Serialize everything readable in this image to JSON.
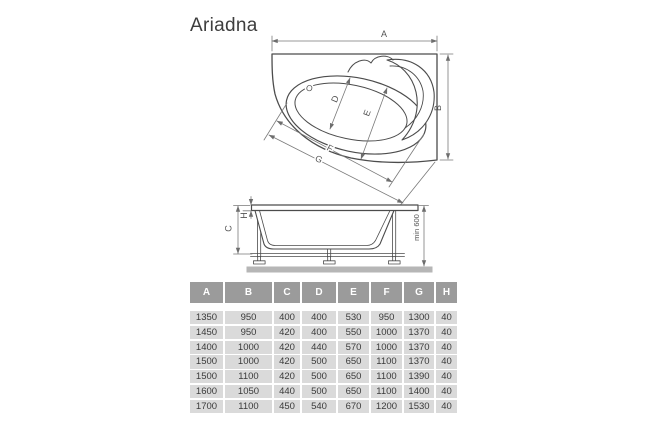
{
  "title": "Ariadna",
  "colors": {
    "outline": "#4c4c4c",
    "dim_line": "#7a7a7a",
    "header_bg": "#9b9b9b",
    "header_text": "#ffffff",
    "row_bg": "#dadada",
    "cell_text": "#3a3a3a",
    "floor": "#b6b6b6"
  },
  "top_view": {
    "labels": {
      "a": "A",
      "b": "B",
      "o": "O",
      "d": "D",
      "e": "E",
      "f": "F",
      "g": "G"
    }
  },
  "side_view": {
    "labels": {
      "c": "C",
      "h": "H",
      "min_height": "min 600"
    }
  },
  "table": {
    "columns": [
      "A",
      "B",
      "C",
      "D",
      "E",
      "F",
      "G",
      "H"
    ],
    "rows": [
      [
        "1350",
        "950",
        "400",
        "400",
        "530",
        "950",
        "1300",
        "40"
      ],
      [
        "1450",
        "950",
        "420",
        "400",
        "550",
        "1000",
        "1370",
        "40"
      ],
      [
        "1400",
        "1000",
        "420",
        "440",
        "570",
        "1000",
        "1370",
        "40"
      ],
      [
        "1500",
        "1000",
        "420",
        "500",
        "650",
        "1100",
        "1370",
        "40"
      ],
      [
        "1500",
        "1100",
        "420",
        "500",
        "650",
        "1100",
        "1390",
        "40"
      ],
      [
        "1600",
        "1050",
        "440",
        "500",
        "650",
        "1100",
        "1400",
        "40"
      ],
      [
        "1700",
        "1100",
        "450",
        "540",
        "670",
        "1200",
        "1530",
        "40"
      ]
    ]
  }
}
